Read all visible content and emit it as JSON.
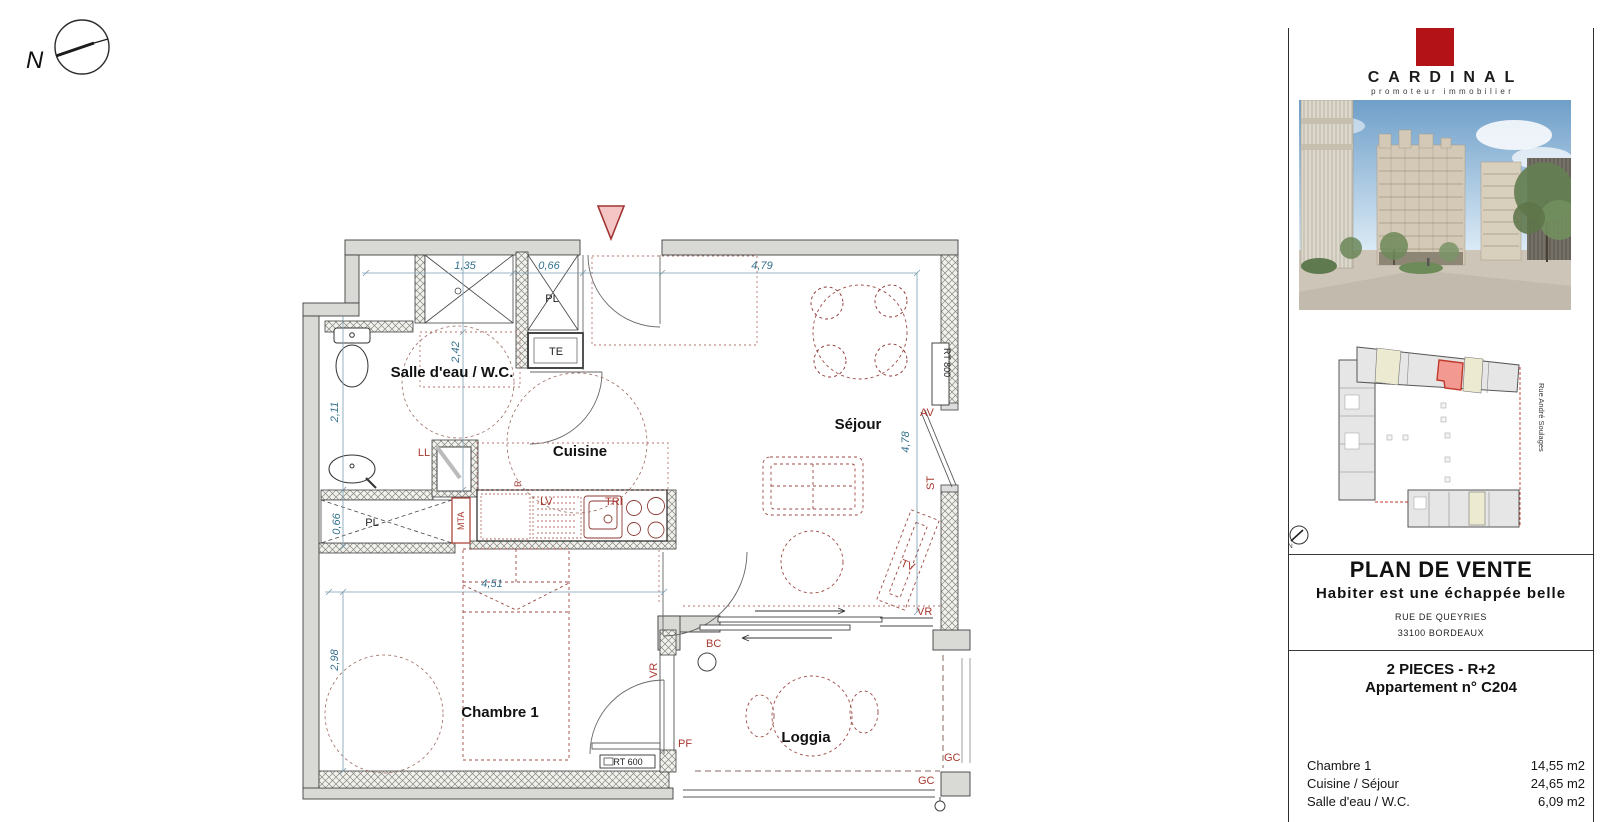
{
  "compass": {
    "label": "N"
  },
  "floorplan": {
    "rooms": {
      "sdb": "Salle d'eau / W.C.",
      "cuisine": "Cuisine",
      "sejour": "Séjour",
      "chambre": "Chambre 1",
      "loggia": "Loggia"
    },
    "dims": {
      "shower_w": "1,35",
      "pl_w": "0,66",
      "sejour_w": "4,79",
      "sdb_h": "2,42",
      "left_h": "2,11",
      "pl_h": "0,66",
      "chambre_w": "4,51",
      "chambre_h": "2,98",
      "sejour_h": "4,78"
    },
    "labels": {
      "pl": "PL",
      "te": "TE",
      "mta": "MTA",
      "ll": "LL",
      "r": "R",
      "lv": "LV",
      "tri": "TRI",
      "rt600": "RT 600",
      "rt800": "RT 800",
      "av": "AV",
      "st": "ST",
      "tv": "TV",
      "vr": "VR",
      "bc": "BC",
      "pf": "PF",
      "gc": "GC"
    }
  },
  "panel": {
    "brand": {
      "name": "CARDINAL",
      "tagline": "promoteur immobilier"
    },
    "siteplan": {
      "street": "Rue André Soulages",
      "compass": "N"
    },
    "title": "PLAN DE VENTE",
    "subtitle": "Habiter est une échappée belle",
    "address1": "RUE DE QUEYRIES",
    "address2": "33100 BORDEAUX",
    "unit_type": "2 PIECES - R+2",
    "unit_number": "Appartement n° C204",
    "areas": [
      {
        "label": "Chambre 1",
        "value": "14,55 m2"
      },
      {
        "label": "Cuisine / Séjour",
        "value": "24,65 m2"
      },
      {
        "label": "Salle d'eau / W.C.",
        "value": "6,09 m2"
      }
    ]
  },
  "colors": {
    "accent_red": "#b31217",
    "dim_blue": "#35718e",
    "furniture_red": "#9c4a44",
    "label_red": "#a8382e",
    "unit_highlight": "#f29a92"
  }
}
